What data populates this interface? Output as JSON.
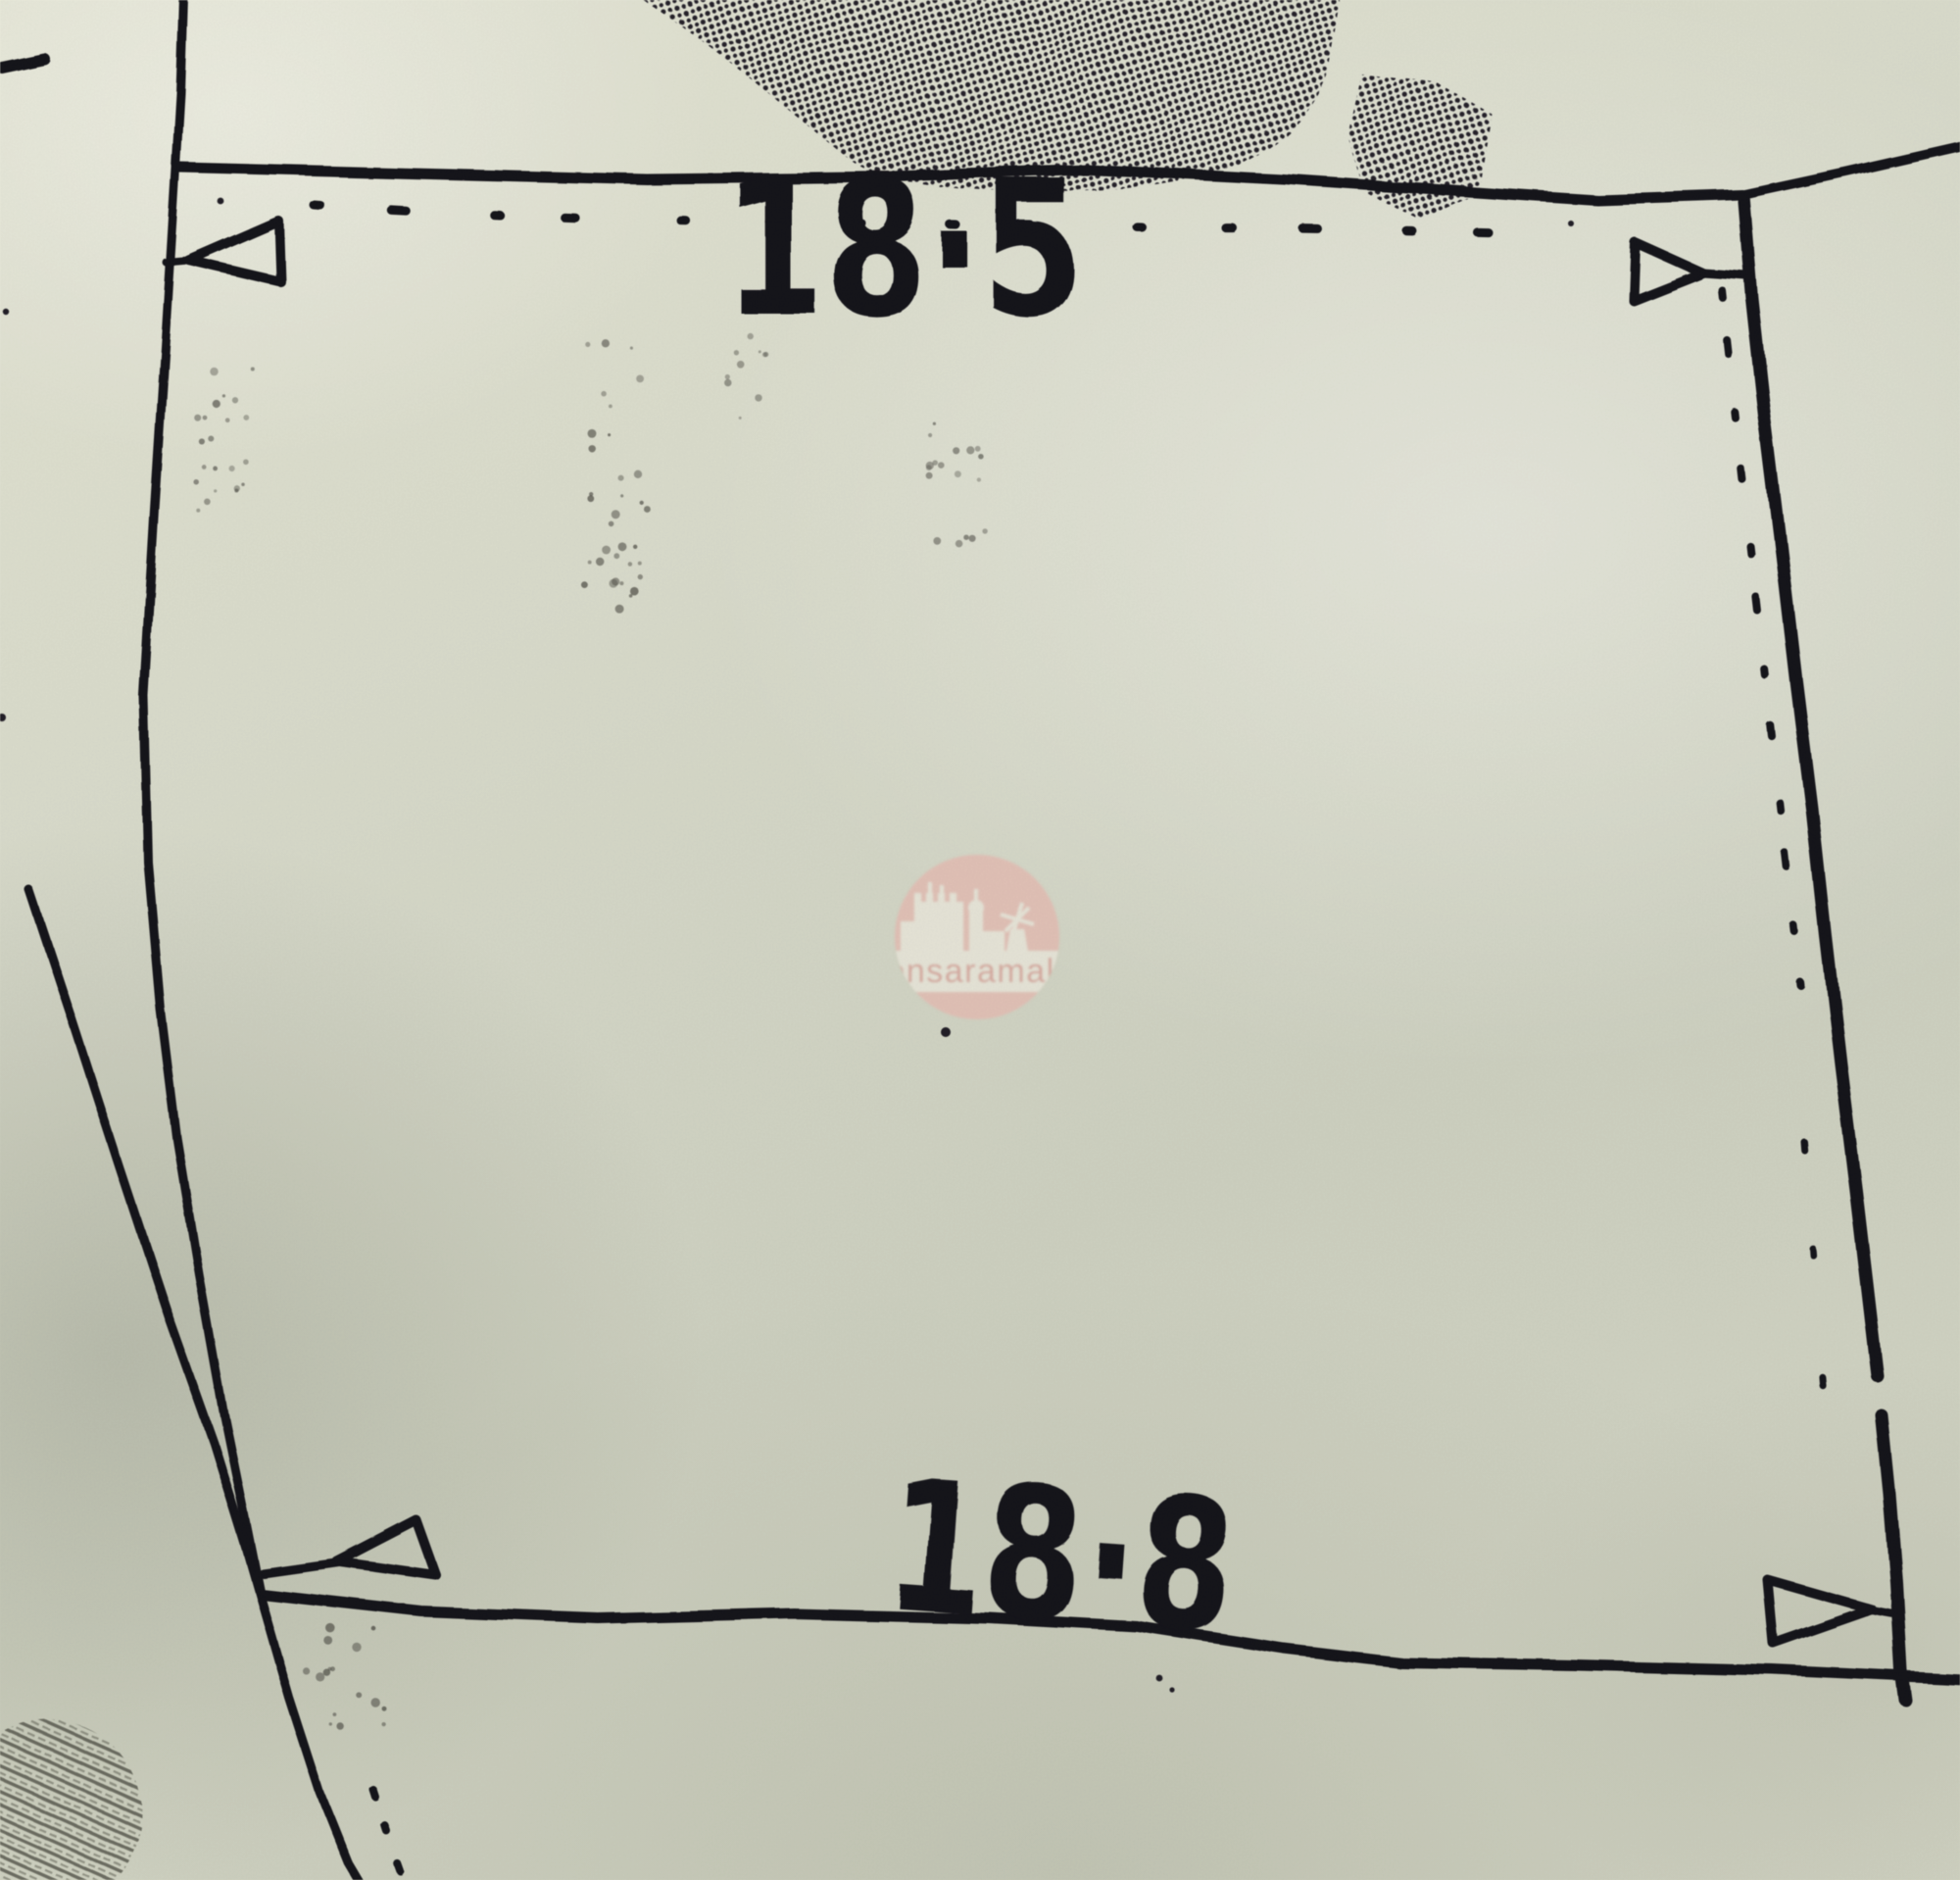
{
  "plan": {
    "top_dimension_label": "18·5",
    "bottom_dimension_label": "18·8",
    "ink_color": "#19161e",
    "paper_color": "#d9dccb",
    "artifact_color": "#55544c"
  },
  "watermark": {
    "brand_text": "sensaramalta",
    "badge_color": "#e8c4ba",
    "silhouette_color": "#edebde",
    "text_color": "#dcaaa0",
    "logo_icon": "castle-windmill-skyline-icon"
  }
}
